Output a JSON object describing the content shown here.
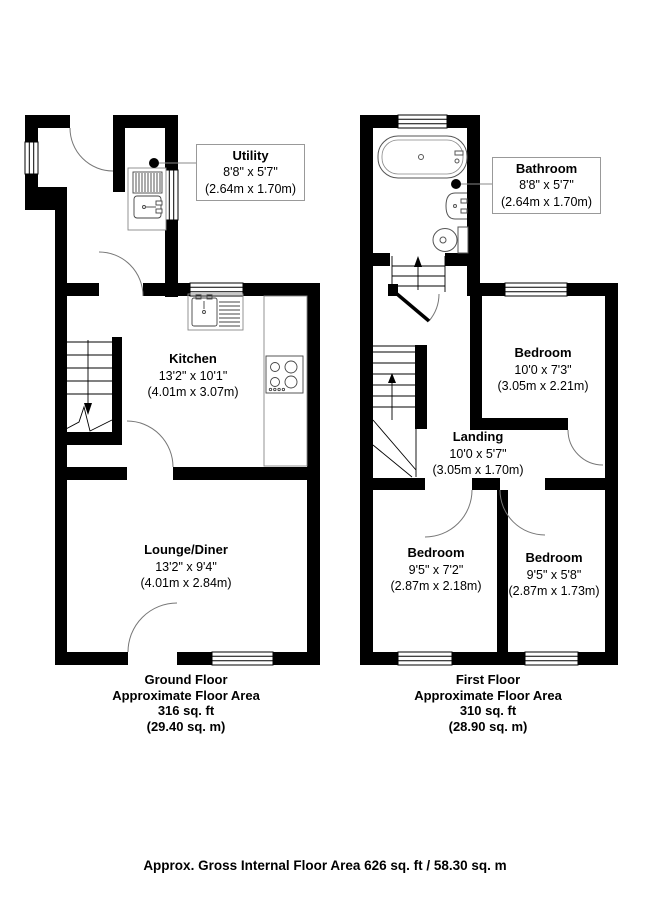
{
  "labels": {
    "utility": {
      "name": "Utility",
      "imperial": "8'8\" x 5'7\"",
      "metric": "(2.64m x 1.70m)"
    },
    "bathroom": {
      "name": "Bathroom",
      "imperial": "8'8\" x 5'7\"",
      "metric": "(2.64m x 1.70m)"
    },
    "kitchen": {
      "name": "Kitchen",
      "imperial": "13'2\" x 10'1\"",
      "metric": "(4.01m x 3.07m)"
    },
    "lounge": {
      "name": "Lounge/Diner",
      "imperial": "13'2\" x 9'4\"",
      "metric": "(4.01m x 2.84m)"
    },
    "bedroom_rear": {
      "name": "Bedroom",
      "imperial": "10'0 x 7'3\"",
      "metric": "(3.05m x 2.21m)"
    },
    "landing": {
      "name": "Landing",
      "imperial": "10'0 x 5'7\"",
      "metric": "(3.05m x 1.70m)"
    },
    "bedroom_front_left": {
      "name": "Bedroom",
      "imperial": "9'5\" x 7'2\"",
      "metric": "(2.87m x 2.18m)"
    },
    "bedroom_front_right": {
      "name": "Bedroom",
      "imperial": "9'5\" x 5'8\"",
      "metric": "(2.87m x 1.73m)"
    }
  },
  "captions": {
    "ground_floor": {
      "title": "Ground Floor",
      "subtitle": "Approximate Floor Area",
      "area_ft": "316 sq. ft",
      "area_m": "(29.40 sq. m)"
    },
    "first_floor": {
      "title": "First Floor",
      "subtitle": "Approximate Floor Area",
      "area_ft": "310 sq. ft",
      "area_m": "(28.90 sq. m)"
    }
  },
  "footer": "Approx. Gross Internal Floor Area 626 sq. ft / 58.30 sq. m",
  "colors": {
    "wall": "#000000",
    "background": "#ffffff",
    "label_box_border": "#999999",
    "door_arc": "#777777"
  }
}
